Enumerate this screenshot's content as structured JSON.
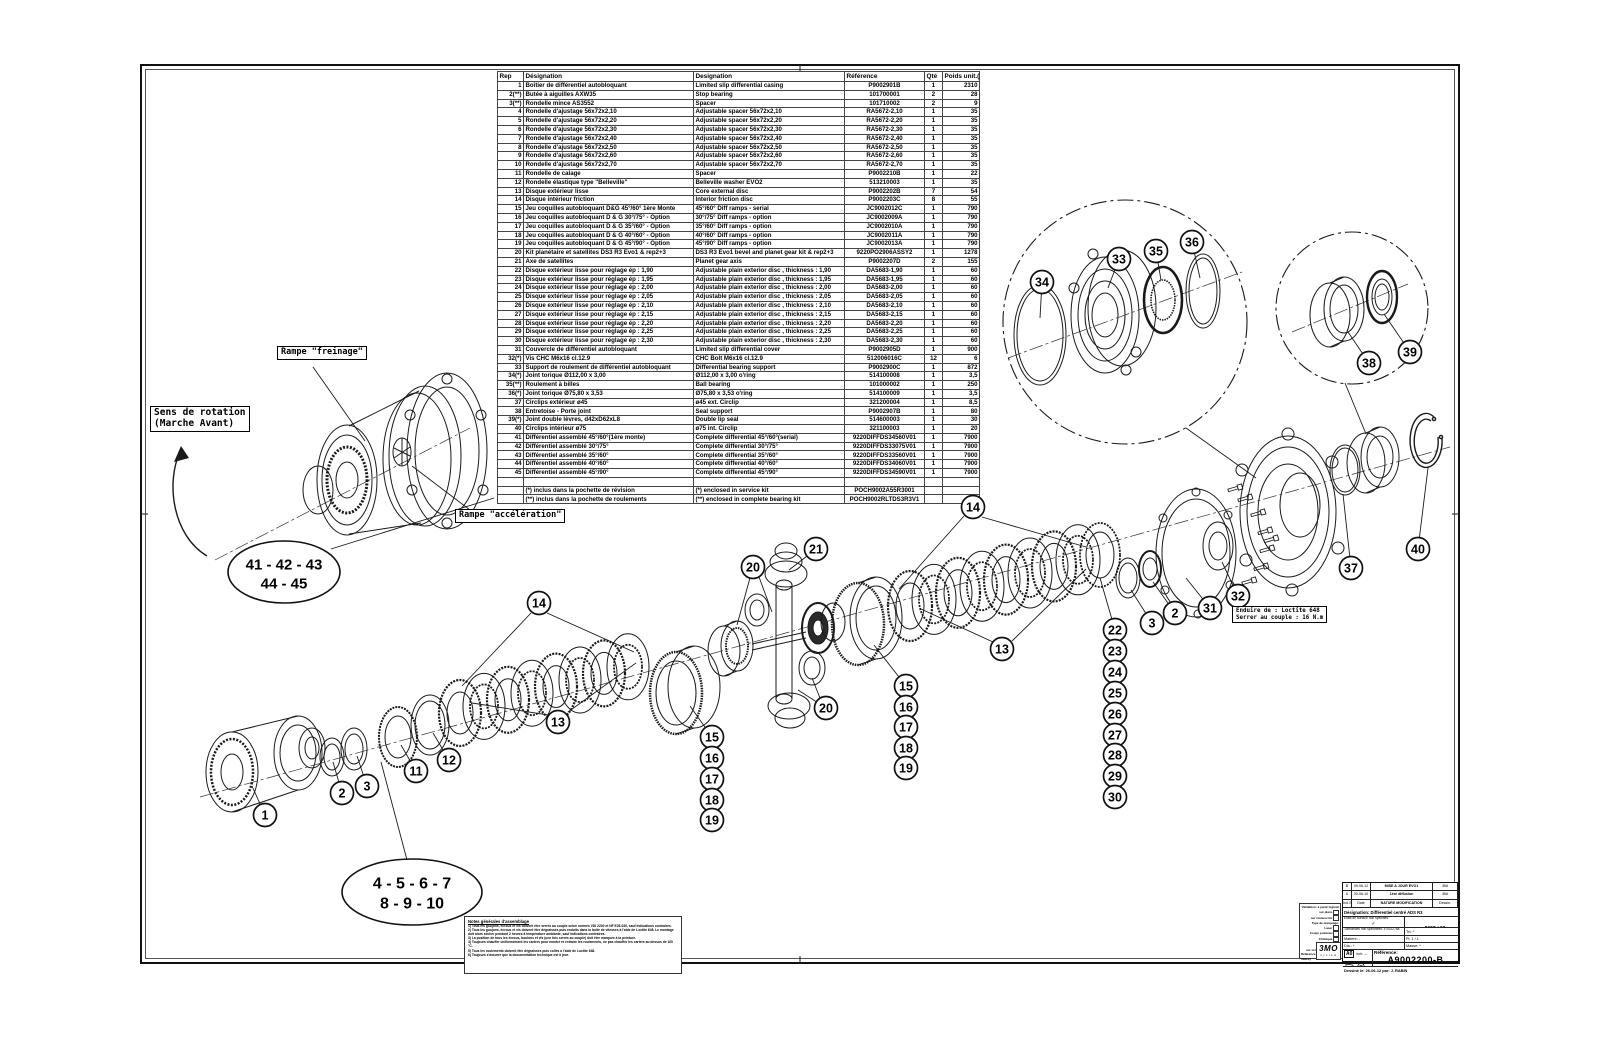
{
  "sheet": {
    "reference": "A9002200-B"
  },
  "parts_table": {
    "headers": [
      "Rep",
      "Désignation",
      "Designation",
      "Référence",
      "Qté",
      "Poids unit.(gr)"
    ],
    "rows": [
      [
        "1",
        "Boîtier de différentiel autobloquant",
        "Limited slip differential casing",
        "P9002901B",
        "1",
        "2310"
      ],
      [
        "2(**)",
        "Butée à aiguilles AXW35",
        "Stop bearing",
        "101700001",
        "2",
        "28"
      ],
      [
        "3(**)",
        "Rondelle mince AS3552",
        "Spacer",
        "101710002",
        "2",
        "9"
      ],
      [
        "4",
        "Rondelle d'ajustage 56x72x2,10",
        "Adjustable spacer 56x72x2,10",
        "RA5672-2,10",
        "1",
        "35"
      ],
      [
        "5",
        "Rondelle d'ajustage 56x72x2,20",
        "Adjustable spacer 56x72x2,20",
        "RA5672-2,20",
        "1",
        "35"
      ],
      [
        "6",
        "Rondelle d'ajustage 56x72x2,30",
        "Adjustable spacer 56x72x2,30",
        "RA5672-2,30",
        "1",
        "35"
      ],
      [
        "7",
        "Rondelle d'ajustage 56x72x2,40",
        "Adjustable spacer 56x72x2,40",
        "RA5672-2,40",
        "1",
        "35"
      ],
      [
        "8",
        "Rondelle d'ajustage 56x72x2,50",
        "Adjustable spacer 56x72x2,50",
        "RA5672-2,50",
        "1",
        "35"
      ],
      [
        "9",
        "Rondelle d'ajustage 56x72x2,60",
        "Adjustable spacer 56x72x2,60",
        "RA5672-2,60",
        "1",
        "35"
      ],
      [
        "10",
        "Rondelle d'ajustage 56x72x2,70",
        "Adjustable spacer 56x72x2,70",
        "RA5672-2,70",
        "1",
        "35"
      ],
      [
        "11",
        "Rondelle de calage",
        "Spacer",
        "P9002210B",
        "1",
        "22"
      ],
      [
        "12",
        "Rondelle élastique type \"Belleville\"",
        "Belleville washer EVO2",
        "513210003",
        "1",
        "35"
      ],
      [
        "13",
        "Disque extérieur lisse",
        "Core external disc",
        "P9002202B",
        "7",
        "54"
      ],
      [
        "14",
        "Disque intérieur friction",
        "Interior friction disc",
        "P9002203C",
        "8",
        "55"
      ],
      [
        "15",
        "Jeu coquilles autobloquant D&G 45°/60° 1ère Monte",
        "45°/60° Diff ramps - serial",
        "JC9002012C",
        "1",
        "790"
      ],
      [
        "16",
        "Jeu coquilles autobloquant D & G 30°/75° - Option",
        "30°/75° Diff ramps - option",
        "JC9002009A",
        "1",
        "790"
      ],
      [
        "17",
        "Jeu coquilles autobloquant D & G 35°/60° - Option",
        "35°/60° Diff ramps - option",
        "JC9002010A",
        "1",
        "790"
      ],
      [
        "18",
        "Jeu coquilles autobloquant D & G 40°/60° - Option",
        "40°/60° Diff ramps - option",
        "JC9002011A",
        "1",
        "790"
      ],
      [
        "19",
        "Jeu coquilles autobloquant D & G 45°/90° - Option",
        "45°/90° Diff ramps - option",
        "JC9002013A",
        "1",
        "790"
      ],
      [
        "20",
        "Kit planétaire et satellites DS3 R3 Evo1 & rep2+3",
        "DS3 R3 Evo1 bevel and planet gear kit & rep2+3",
        "9220PO2906ASSY2",
        "1",
        "1278"
      ],
      [
        "21",
        "Axe de satellites",
        "Planet gear axis",
        "P9002207D",
        "2",
        "155"
      ],
      [
        "22",
        "Disque extérieur lisse pour réglage ép : 1,90",
        "Adjustable plain exterior disc , thickness : 1,90",
        "DA5683-1,90",
        "1",
        "60"
      ],
      [
        "23",
        "Disque extérieur lisse pour réglage ép : 1,95",
        "Adjustable plain exterior disc , thickness : 1,95",
        "DA5683-1,95",
        "1",
        "60"
      ],
      [
        "24",
        "Disque extérieur lisse pour réglage ép : 2,00",
        "Adjustable plain exterior disc , thickness : 2,00",
        "DA5683-2,00",
        "1",
        "60"
      ],
      [
        "25",
        "Disque extérieur lisse pour réglage ép : 2,05",
        "Adjustable plain exterior disc , thickness : 2,05",
        "DA5683-2,05",
        "1",
        "60"
      ],
      [
        "26",
        "Disque extérieur lisse pour réglage ép : 2,10",
        "Adjustable plain exterior disc , thickness : 2,10",
        "DA5683-2,10",
        "1",
        "60"
      ],
      [
        "27",
        "Disque extérieur lisse pour réglage ép : 2,15",
        "Adjustable plain exterior disc , thickness : 2,15",
        "DA5683-2,15",
        "1",
        "60"
      ],
      [
        "28",
        "Disque extérieur lisse pour réglage ép : 2,20",
        "Adjustable plain exterior disc , thickness : 2,20",
        "DA5683-2,20",
        "1",
        "60"
      ],
      [
        "29",
        "Disque extérieur lisse pour réglage ép : 2,25",
        "Adjustable plain exterior disc , thickness : 2,25",
        "DA5683-2,25",
        "1",
        "60"
      ],
      [
        "30",
        "Disque extérieur lisse pour réglage ép : 2,30",
        "Adjustable plain exterior disc , thickness : 2,30",
        "DA5683-2,30",
        "1",
        "60"
      ],
      [
        "31",
        "Couvercle de différentiel autobloquant",
        "Limited slip differential cover",
        "P9002905D",
        "1",
        "900"
      ],
      [
        "32(*)",
        "Vis CHC M6x16 cl.12.9",
        "CHC Bolt M6x16 cl.12.9",
        "512006016C",
        "12",
        "6"
      ],
      [
        "33",
        "Support de roulement de différentiel autobloquant",
        "Differential bearing support",
        "P9002900C",
        "1",
        "872"
      ],
      [
        "34(*)",
        "Joint torique Ø112,00 x 3,00",
        "Ø112,00 x 3,00 o'ring",
        "514100008",
        "1",
        "3,5"
      ],
      [
        "35(**)",
        "Roulement à billes",
        "Ball bearing",
        "101000002",
        "1",
        "250"
      ],
      [
        "36(*)",
        "Joint torique Ø75,80 x 3,53",
        "Ø75,80 x 3,53 o'ring",
        "514100009",
        "1",
        "3,5"
      ],
      [
        "37",
        "Circlips extérieur ø45",
        "ø45 ext. Circlip",
        "321200004",
        "1",
        "8,5"
      ],
      [
        "38",
        "Entretoise - Porte joint",
        "Seal support",
        "P9002907B",
        "1",
        "80"
      ],
      [
        "39(*)",
        "Joint double lèvres, d42xD62xL8",
        "Double lip seal",
        "514600003",
        "1",
        "30"
      ],
      [
        "40",
        "Circlips intérieur ø75",
        "ø75 int. Circlip",
        "321100003",
        "1",
        "20"
      ],
      [
        "41",
        "Différentiel assemblé 45°/60°(1ère monte)",
        "Complete differential 45°/60°(serial)",
        "9220DIFFDS34560V01",
        "1",
        "7900"
      ],
      [
        "42",
        "Différentiel assemblé 30°/75°",
        "Complete differential 30°/75°",
        "9220DIFFDS33075V01",
        "1",
        "7900"
      ],
      [
        "43",
        "Différentiel assemblé 35°/60°",
        "Complete differential 35°/60°",
        "9220DIFFDS33560V01",
        "1",
        "7900"
      ],
      [
        "44",
        "Différentiel assemblé 40°/60°",
        "Complete differential 40°/60°",
        "9220DIFFDS34060V01",
        "1",
        "7900"
      ],
      [
        "45",
        "Différentiel assemblé 45°/90°",
        "Complete differential 45°/90°",
        "9220DIFFDS34590V01",
        "1",
        "7900"
      ]
    ],
    "footnotes": [
      [
        "",
        "(*) inclus dans la pochette de révision",
        "(*) enclosed in service kit",
        "POCH9002A55R3001",
        "",
        ""
      ],
      [
        "",
        "(**) inclus dans la pochette de roulements",
        "(**) enclosed in complete bearing kit",
        "POCH9002RLTDS3R3V1",
        "",
        ""
      ]
    ]
  },
  "labels": {
    "rampe_freinage": "Rampe \"freinage\"",
    "sens_rotation": [
      "Sens de rotation",
      "(Marche Avant)"
    ],
    "rampe_acceleration": "Rampe \"accélération\""
  },
  "loctite_note": [
    "Enduire de : Loctite 648",
    "Serrer au couple : 16 N.m"
  ],
  "ovals": [
    {
      "lines": [
        "41 - 42 - 43",
        "44 - 45"
      ],
      "cx": 284,
      "cy": 572,
      "rx": 56,
      "ry": 31,
      "fs": 15
    },
    {
      "lines": [
        "4 - 5 - 6 - 7",
        "8 - 9 - 10"
      ],
      "cx": 412,
      "cy": 892,
      "rx": 70,
      "ry": 33,
      "fs": 16
    }
  ],
  "callouts": [
    {
      "n": "1",
      "x": 265,
      "y": 815,
      "tx": 252,
      "ty": 786
    },
    {
      "n": "2",
      "x": 342,
      "y": 793,
      "tx": 333,
      "ty": 762
    },
    {
      "n": "3",
      "x": 367,
      "y": 786,
      "tx": 357,
      "ty": 756
    },
    {
      "n": "11",
      "x": 416,
      "y": 771,
      "tx": 401,
      "ty": 745
    },
    {
      "n": "12",
      "x": 449,
      "y": 760,
      "tx": 433,
      "ty": 733
    },
    {
      "n": "13",
      "x": 558,
      "y": 722
    },
    {
      "n": "14",
      "x": 539,
      "y": 603
    },
    {
      "n": "15",
      "x": 712,
      "y": 737,
      "tx": 690,
      "ty": 706
    },
    {
      "n": "16",
      "x": 712,
      "y": 758
    },
    {
      "n": "17",
      "x": 712,
      "y": 779
    },
    {
      "n": "18",
      "x": 712,
      "y": 800
    },
    {
      "n": "19",
      "x": 712,
      "y": 820
    },
    {
      "n": "20",
      "x": 753,
      "y": 567,
      "tx": 737,
      "ty": 625
    },
    {
      "n": "21",
      "x": 816,
      "y": 549,
      "tx": 789,
      "ty": 570
    },
    {
      "n": "20",
      "x": 826,
      "y": 708,
      "tx": 798,
      "ty": 690
    },
    {
      "n": "15",
      "x": 906,
      "y": 686,
      "tx": 874,
      "ty": 645
    },
    {
      "n": "16",
      "x": 906,
      "y": 707
    },
    {
      "n": "17",
      "x": 906,
      "y": 727
    },
    {
      "n": "18",
      "x": 906,
      "y": 748
    },
    {
      "n": "19",
      "x": 906,
      "y": 768
    },
    {
      "n": "14",
      "x": 973,
      "y": 507
    },
    {
      "n": "13",
      "x": 1002,
      "y": 649
    },
    {
      "n": "22",
      "x": 1115,
      "y": 630,
      "tx": 1100,
      "ty": 578
    },
    {
      "n": "23",
      "x": 1115,
      "y": 651
    },
    {
      "n": "24",
      "x": 1115,
      "y": 672
    },
    {
      "n": "25",
      "x": 1115,
      "y": 693
    },
    {
      "n": "26",
      "x": 1115,
      "y": 714
    },
    {
      "n": "27",
      "x": 1115,
      "y": 735
    },
    {
      "n": "28",
      "x": 1115,
      "y": 755
    },
    {
      "n": "29",
      "x": 1115,
      "y": 776
    },
    {
      "n": "30",
      "x": 1115,
      "y": 797
    },
    {
      "n": "3",
      "x": 1152,
      "y": 623,
      "tx": 1131,
      "ty": 590
    },
    {
      "n": "2",
      "x": 1175,
      "y": 613,
      "tx": 1153,
      "ty": 582
    },
    {
      "n": "31",
      "x": 1210,
      "y": 608,
      "tx": 1186,
      "ty": 578
    },
    {
      "n": "32",
      "x": 1238,
      "y": 596,
      "tx": 1222,
      "ty": 562
    },
    {
      "n": "37",
      "x": 1351,
      "y": 568,
      "tx": 1343,
      "ty": 494
    },
    {
      "n": "40",
      "x": 1418,
      "y": 549,
      "tx": 1428,
      "ty": 468
    },
    {
      "n": "34",
      "x": 1042,
      "y": 282,
      "tx": 1040,
      "ty": 318
    },
    {
      "n": "33",
      "x": 1119,
      "y": 259,
      "tx": 1108,
      "ty": 288
    },
    {
      "n": "35",
      "x": 1156,
      "y": 251,
      "tx": 1161,
      "ty": 280
    },
    {
      "n": "36",
      "x": 1192,
      "y": 242,
      "tx": 1200,
      "ty": 278
    },
    {
      "n": "38",
      "x": 1369,
      "y": 363,
      "tx": 1348,
      "ty": 332
    },
    {
      "n": "39",
      "x": 1410,
      "y": 352,
      "tx": 1384,
      "ty": 314
    }
  ],
  "notes_block": {
    "title": "Notes générales d'assemblage",
    "items": [
      "1) Tous les goujons, écrous et vis doivent être serrés au couple selon normes VDI 2230 et NF E25-030, sauf indications contraires.",
      "2) Tous les goujons, écrous et vis doivent être dégraissés puis enduits dans la boîte de vitesses à l'aide de Loctite 648. Le montage doit alors sécher pendant 2 heures à température ambiante, sauf indications contraires.",
      "3) La position de tous les écrous, boulons et vis (une fois serrés au couple) doit être marquée à la peinture.",
      "4) Toujours chauffer uniformément les carters pour monter et extraire les roulements, ne pas chauffer les carters au dessus de 100 °C.",
      "5) Tous les roulements doivent être dégraissés puis collés à l'aide de Loctite 648.",
      "6) Toujours s'assurer que la documentation technique est à jour."
    ]
  },
  "validation_block": {
    "rows": [
      {
        "t": "Validation:  à partir logiciel",
        "box": false
      },
      {
        "t": "sur plans",
        "box": true
      },
      {
        "t": "sur manuscrits",
        "box": true
      },
      {
        "t": "Type de marquage:",
        "box": false
      },
      {
        "t": "Laser",
        "box": true
      },
      {
        "t": "Coups pointeau",
        "box": true
      },
      {
        "t": "Chimique",
        "box": true
      },
      {
        "t": "Autres",
        "box": true
      },
      {
        "t": "sur zone spécifiée plan",
        "box": false
      },
      {
        "t": "Référence pièce (N° + indice)",
        "box": false
      }
    ]
  },
  "title_block": {
    "rev_rows": [
      [
        "B",
        "09-06-12",
        "MISE A JOUR EVO1",
        "JBA"
      ],
      [
        "A",
        "30-06-10",
        "1ère diffusion",
        "JBA"
      ],
      [
        "Ind./Sym",
        "Date",
        "NATURE MODIFICATION",
        "Dessin."
      ]
    ],
    "designation": "Désignation: Différentiel centré  ADS R3",
    "surface_label": "Etats de surface non spécifiés:",
    "check": "✓",
    "projet_label": "N° Projet:",
    "projet_value": "9002 / 00",
    "tol_label": "Tolérances non spécifiées: ± ISO2768",
    "trt": "Trt:  *",
    "matiere": "Matière:      -",
    "pl": "Pl:  1 / 1",
    "dia": "Dia.:      *",
    "masse": "Masse:  *",
    "format": "A0",
    "ech": "ech: -:-",
    "ref_label": "Référence:",
    "ref_value": "A9002200-B",
    "drawn": "Dessiné le: 26-06-12   par: J. RABIN",
    "logo": "3MO",
    "logo_sub": "s y s t e m"
  }
}
